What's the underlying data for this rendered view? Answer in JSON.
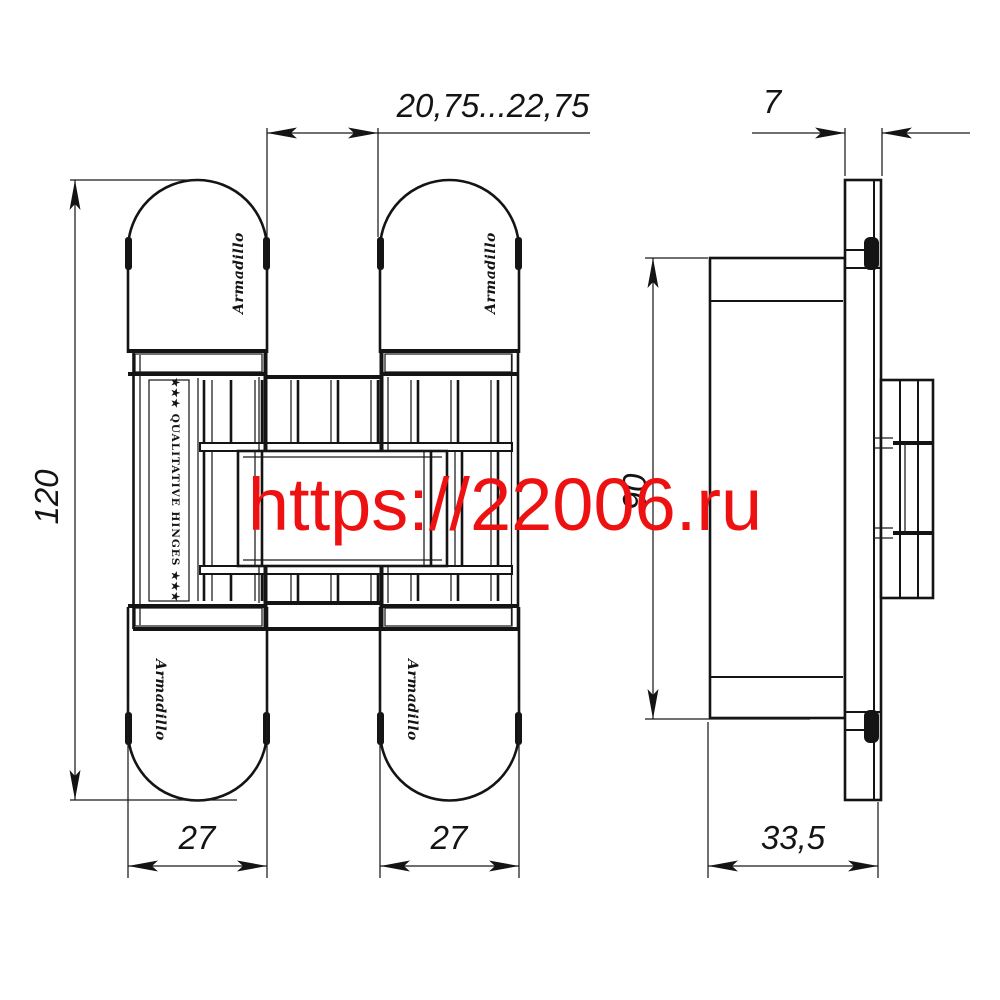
{
  "watermark": {
    "text": "https://22006.ru",
    "color": "#ee1111"
  },
  "drawing": {
    "brand": "Armadillo",
    "quality_strip": "★★★ QUALITATIVE HINGES ★★★",
    "line_color": "#141414",
    "background": "#ffffff",
    "dimensions": {
      "gap": "20,75...22,75",
      "leaf_thickness": "7",
      "overall_height": "120",
      "case_height": "90",
      "leaf_width_left": "27",
      "leaf_width_right": "27",
      "case_depth": "33,5"
    }
  }
}
